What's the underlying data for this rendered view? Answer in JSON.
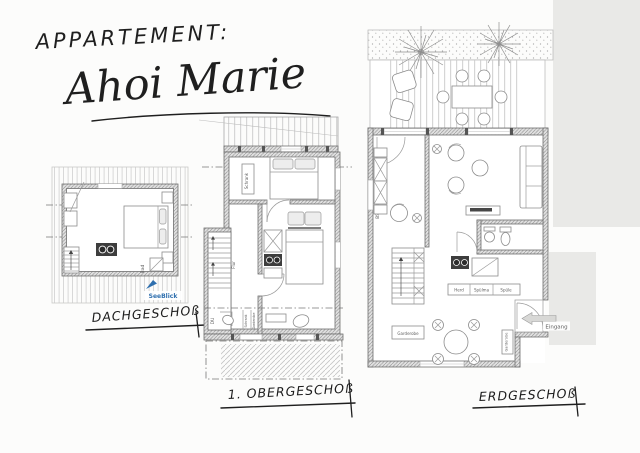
{
  "header": {
    "label": "APPARTEMENT:",
    "name": "Ahoi Marie"
  },
  "plans": {
    "dachgeschoss": {
      "caption": "DACHGESCHOß",
      "labels": {
        "seeblick": "SeeBlick",
        "bad": "Bad"
      }
    },
    "obergeschoss": {
      "caption": "1. OBERGESCHOß",
      "labels": {
        "schrank": "Schrank",
        "flur": "Flur",
        "du": "DU",
        "schrank2": "Schrank",
        "garderobe": "Garderobe"
      }
    },
    "erdgeschoss": {
      "caption": "ERDGESCHOß",
      "labels": {
        "bs_wand": "BS Wand = 50 DB",
        "herd": "Herd",
        "spuelma": "Spülma",
        "spuele": "Spüle",
        "garderobe": "Garderobe",
        "eingang": "Eingang"
      }
    }
  },
  "colors": {
    "ink": "#1f1f1f",
    "accent_blue": "#2f6fae",
    "gray_area": "#e9e9e7"
  }
}
